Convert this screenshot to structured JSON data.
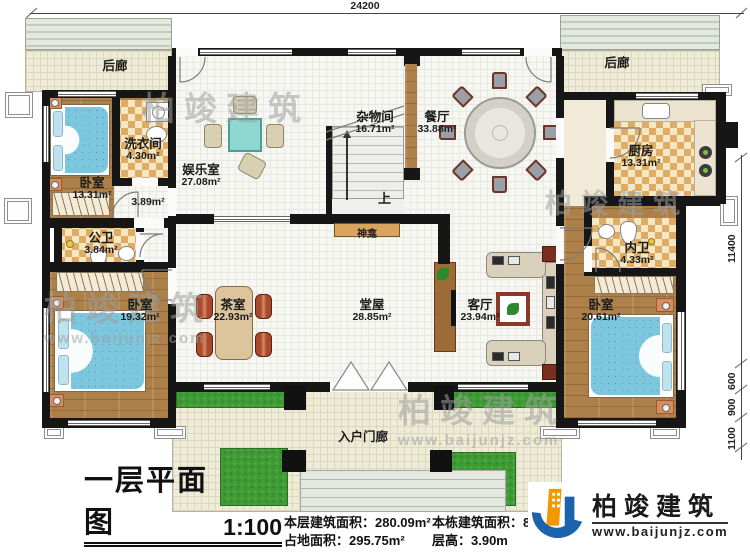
{
  "plan": {
    "dims": {
      "top_width": "24200",
      "right_height": "11400",
      "right_sub": [
        "600",
        "900",
        "1100"
      ]
    },
    "rooms": {
      "rear_porch_left": {
        "name": "后廊"
      },
      "rear_porch_right": {
        "name": "后廊"
      },
      "bedroom_tl": {
        "name": "卧室",
        "area": "13.31m²"
      },
      "laundry": {
        "name": "洗衣间",
        "area": "4.30m²"
      },
      "hallway": {
        "area": "3.89m²"
      },
      "entertainment": {
        "name": "娱乐室",
        "area": "27.08m²"
      },
      "storage": {
        "name": "杂物间",
        "area": "16.71m²"
      },
      "dining": {
        "name": "餐厅",
        "area": "33.88m²"
      },
      "kitchen": {
        "name": "厨房",
        "area": "13.31m²"
      },
      "public_bath": {
        "name": "公卫",
        "area": "3.84m²"
      },
      "inner_bath": {
        "name": "内卫",
        "area": "4.33m²"
      },
      "bedroom_bl": {
        "name": "卧室",
        "area": "19.32m²"
      },
      "tea_room": {
        "name": "茶室",
        "area": "22.93m²"
      },
      "main_hall": {
        "name": "堂屋",
        "area": "28.85m²"
      },
      "living_room": {
        "name": "客厅",
        "area": "23.94m²"
      },
      "bedroom_br": {
        "name": "卧室",
        "area": "20.61m²"
      },
      "entry_porch": {
        "name": "入户门廊"
      }
    },
    "stairs_up_label": "上",
    "shrine_label": "神龛"
  },
  "title_block": {
    "title": "一层平面图",
    "scale": "1:100",
    "stats_col1": [
      "本层建筑面积：280.09m²",
      "占地面积：295.75m²"
    ],
    "stats_col2": [
      "本栋建筑面积：825.",
      "层高：3.90m"
    ]
  },
  "branding": {
    "logo_text": "柏竣建筑",
    "logo_url": "www.baijunjz.com"
  },
  "watermark": {
    "text": "柏竣建筑",
    "url": "www.baijunjz.com"
  },
  "colors": {
    "wall": "#161616",
    "wood_floor": "#ad8049",
    "checker_tile": "#dfac66",
    "bed_blue": "#7cc6de",
    "grass": "#3f9b35",
    "logo_blue": "#1c63ad",
    "logo_orange": "#f39800",
    "shrine_tan": "#d8a55e"
  }
}
